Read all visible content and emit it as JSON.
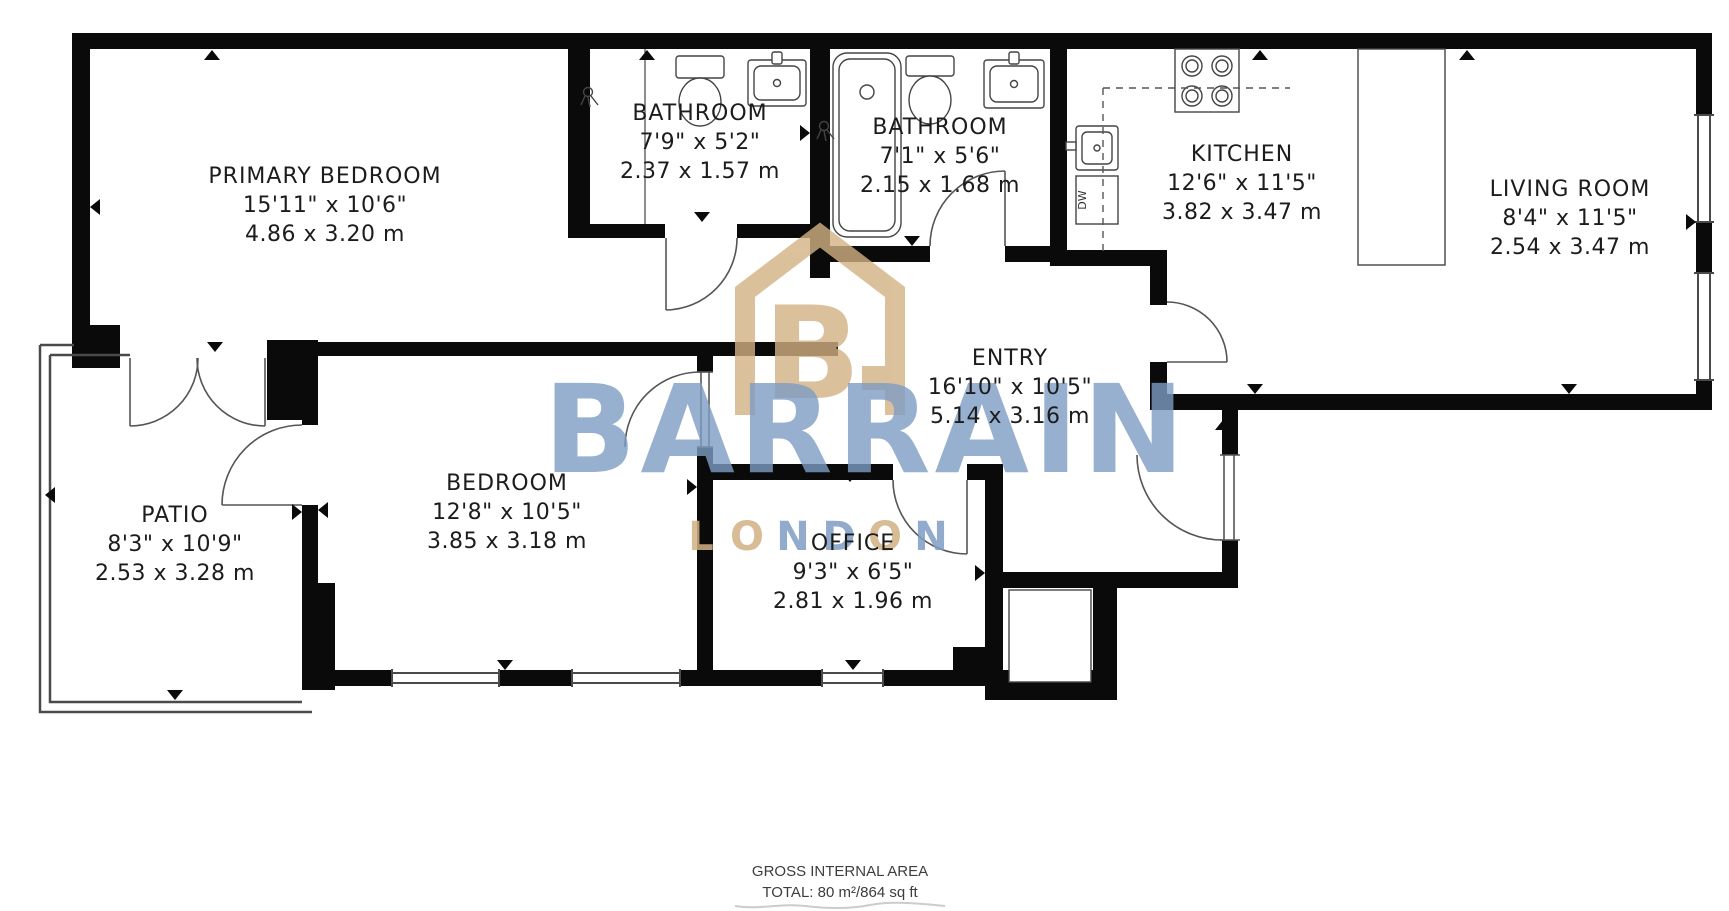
{
  "rooms": [
    {
      "id": "primary-bedroom",
      "name": "PRIMARY BEDROOM",
      "imperial": "15'11\" x 10'6\"",
      "metric": "4.86 x 3.20 m"
    },
    {
      "id": "bathroom-1",
      "name": "BATHROOM",
      "imperial": "7'9\" x 5'2\"",
      "metric": "2.37 x 1.57 m"
    },
    {
      "id": "bathroom-2",
      "name": "BATHROOM",
      "imperial": "7'1\" x 5'6\"",
      "metric": "2.15 x 1.68 m"
    },
    {
      "id": "kitchen",
      "name": "KITCHEN",
      "imperial": "12'6\" x 11'5\"",
      "metric": "3.82 x 3.47 m"
    },
    {
      "id": "living-room",
      "name": "LIVING ROOM",
      "imperial": "8'4\" x 11'5\"",
      "metric": "2.54 x 3.47 m"
    },
    {
      "id": "entry",
      "name": "ENTRY",
      "imperial": "16'10\" x 10'5\"",
      "metric": "5.14 x 3.16 m"
    },
    {
      "id": "patio",
      "name": "PATIO",
      "imperial": "8'3\" x 10'9\"",
      "metric": "2.53 x 3.28 m"
    },
    {
      "id": "bedroom",
      "name": "BEDROOM",
      "imperial": "12'8\" x 10'5\"",
      "metric": "3.85 x 3.18 m"
    },
    {
      "id": "office",
      "name": "OFFICE",
      "imperial": "9'3\" x 6'5\"",
      "metric": "2.81 x 1.96 m"
    }
  ],
  "fixtures": {
    "dishwasher_label": "DW"
  },
  "watermark": {
    "letter": "B",
    "brand": "BARRAIN",
    "city": "LONDON",
    "city_letters": [
      "L",
      "O",
      "N",
      "D",
      "O",
      "N"
    ]
  },
  "footer": {
    "line1": "GROSS INTERNAL AREA",
    "line2": "TOTAL: 80 m²/864 sq ft"
  },
  "colors": {
    "wall": "#0a0a0a",
    "line": "#4a4a4a",
    "brand_tan": "#d2b183",
    "brand_blue": "#7f9dc4",
    "text": "#1c1c1c",
    "footer_text": "#3d3d3d"
  }
}
